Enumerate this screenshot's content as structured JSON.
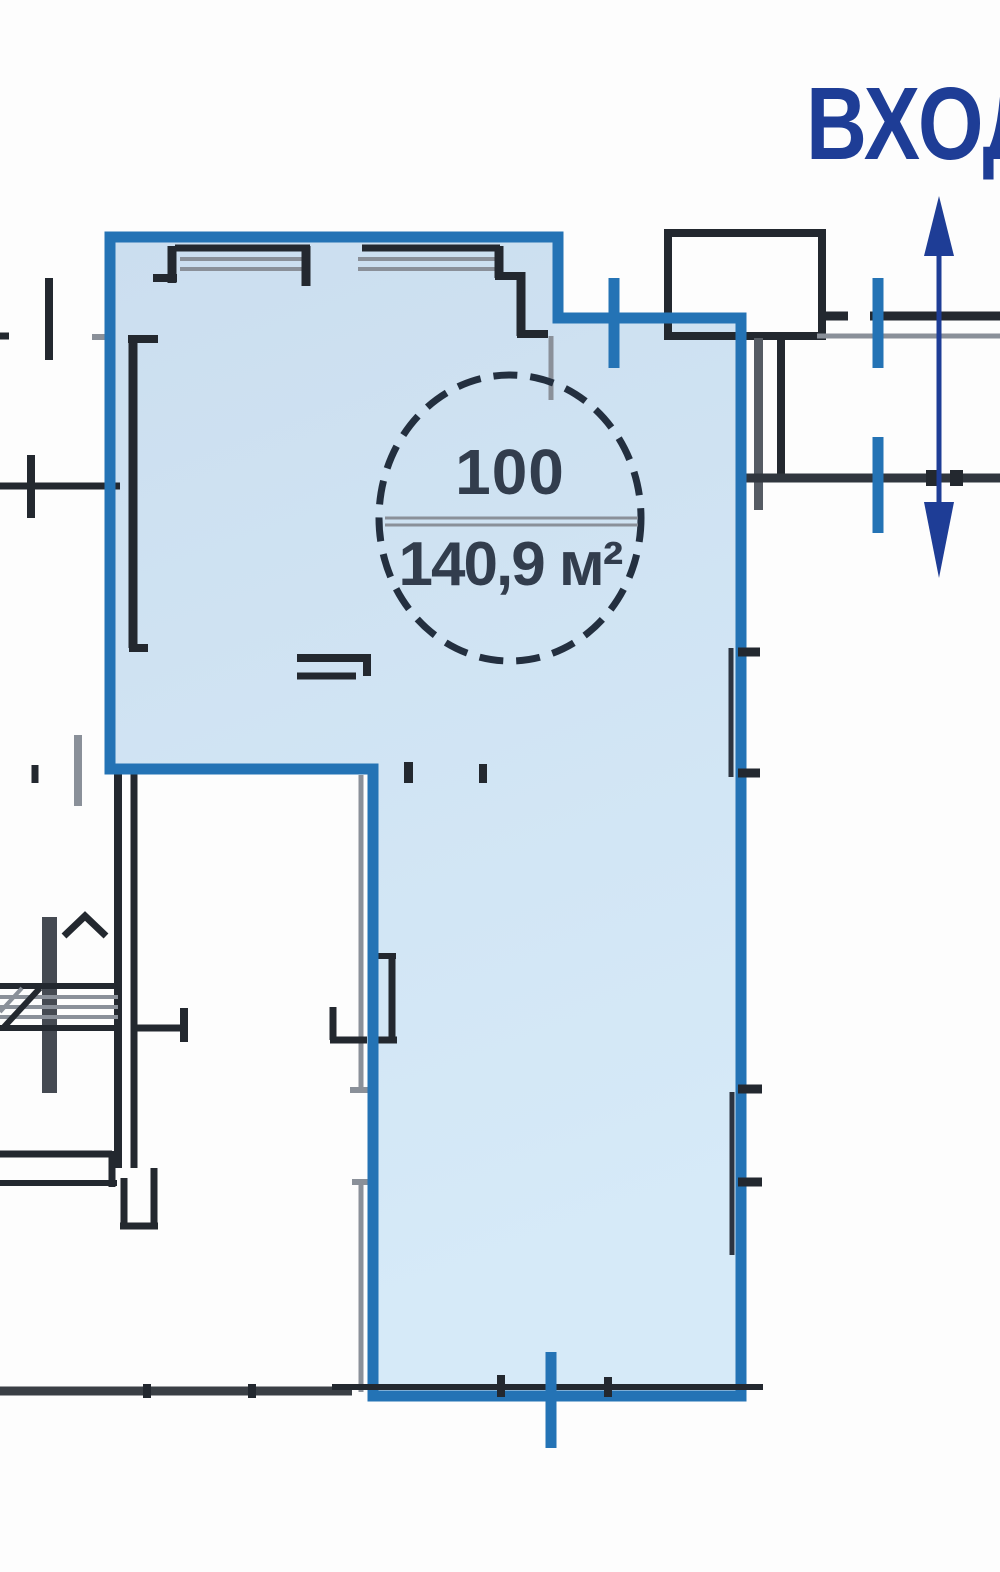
{
  "unit": {
    "number": "100",
    "area": "140,9 м²"
  },
  "entrance_label": "ВХОД",
  "colors": {
    "highlight_border": "#2473b5",
    "highlight_fill": "#cfe1f3",
    "wall": "#23282f",
    "gray_line": "#8a9099",
    "annotation_navy": "#1e3d96",
    "label_text": "#323d4d"
  }
}
